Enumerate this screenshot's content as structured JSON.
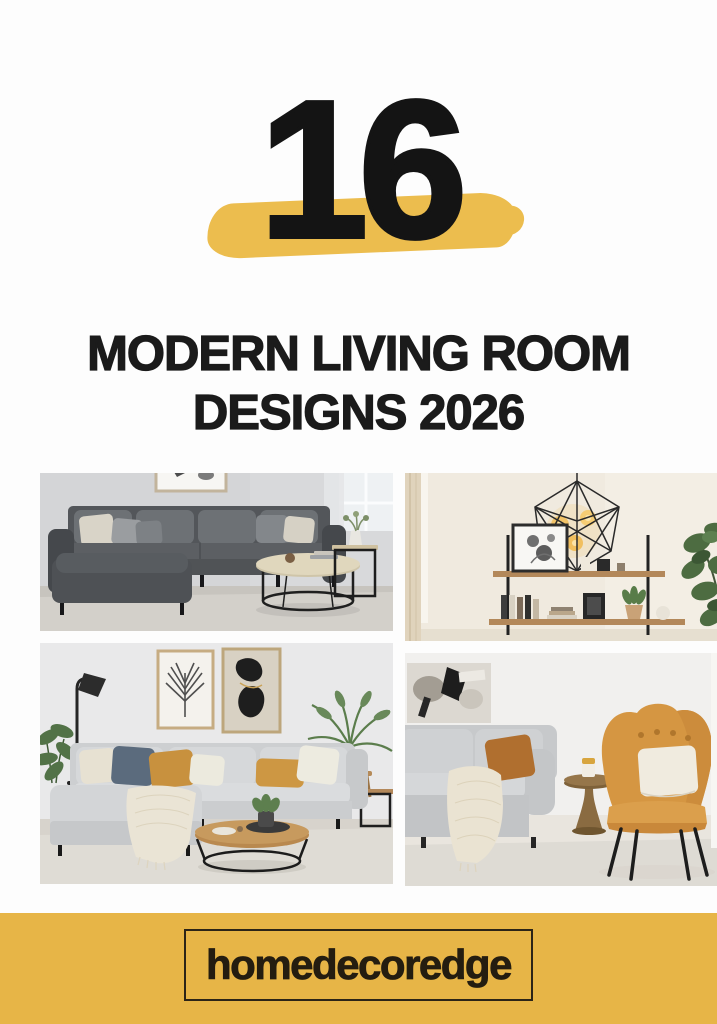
{
  "poster": {
    "background_color": "#fdfdfd",
    "count": "16",
    "count_color": "#141414",
    "highlight_color": "#ecbd4e",
    "title_line1": "MODERN LIVING ROOM",
    "title_line2": "DESIGNS 2026",
    "title_color": "#1b1b1b"
  },
  "collage": {
    "photos": [
      {
        "id": "charcoal-sectional",
        "description": "Charcoal gray sectional sofa with cream and gray pillows, framed abstract art cut off at the top, round black-metal coffee table with light wood top, black cube side table with white vase and plant, bright window with sheer curtain"
      },
      {
        "id": "geometric-pendant-shelf",
        "description": "Black geometric wire pendant lamp with glowing Edison bulbs above a black-and-wood ladder shelf styled with books, a leaning framed botanical print, candle and small plant; tall fiddle-leaf fig plant on the right and beige curtain on the left"
      },
      {
        "id": "greige-sectional-mustard-pillows",
        "description": "Light gray sectional with cream, slate-blue and mustard pillows and a chunky knit throw, palm-leaf print and black abstract art in wood frames, black floor lamp, round wood coffee table with black ring base, areca palm on a wooden stool"
      },
      {
        "id": "mustard-wingback-chair",
        "description": "Mustard yellow wingback armchair with black splayed legs and a white pillow beside a gray sofa with rust pillow and draped cream throw, bronze pedestal side table with a candle, abstract canvas art and white curtain"
      }
    ]
  },
  "footer": {
    "band_color": "#e7b547",
    "brand": "homedecoredge",
    "brand_color": "#241d10",
    "box_border_color": "#2c2417"
  }
}
